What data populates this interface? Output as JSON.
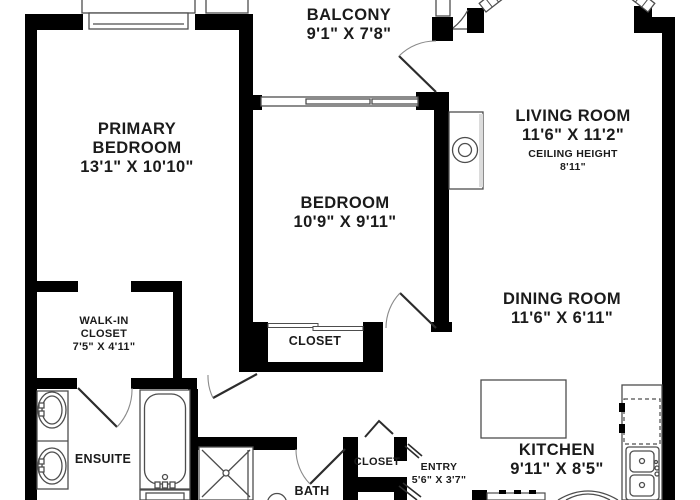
{
  "floorplan": {
    "background": "#ffffff",
    "wall_color": "#000000",
    "line_color": "#4d4d4d",
    "text_color": "#1b1b1b",
    "rooms": {
      "balcony": {
        "name": "BALCONY",
        "dims": "9'1\" X 7'8\""
      },
      "primary_bedroom": {
        "line1": "PRIMARY",
        "line2": "BEDROOM",
        "dims": "13'1\" X 10'10\""
      },
      "bedroom": {
        "name": "BEDROOM",
        "dims": "10'9\" X 9'11\""
      },
      "living_room": {
        "name": "LIVING ROOM",
        "dims": "11'6\" X 11'2\"",
        "ceiling_label": "CEILING HEIGHT",
        "ceiling_value": "8'11\""
      },
      "dining_room": {
        "name": "DINING ROOM",
        "dims": "11'6\" X 6'11\""
      },
      "kitchen": {
        "name": "KITCHEN",
        "dims": "9'11\" X 8'5\""
      },
      "walk_in_closet": {
        "line1": "WALK-IN",
        "line2": "CLOSET",
        "dims": "7'5\" X 4'11\""
      },
      "ensuite": {
        "name": "ENSUITE"
      },
      "bath": {
        "name": "BATH"
      },
      "bedroom_closet": {
        "name": "CLOSET"
      },
      "entry_closet": {
        "name": "CLOSET"
      },
      "entry": {
        "name": "ENTRY",
        "dims": "5'6\" X 3'7\""
      }
    }
  }
}
